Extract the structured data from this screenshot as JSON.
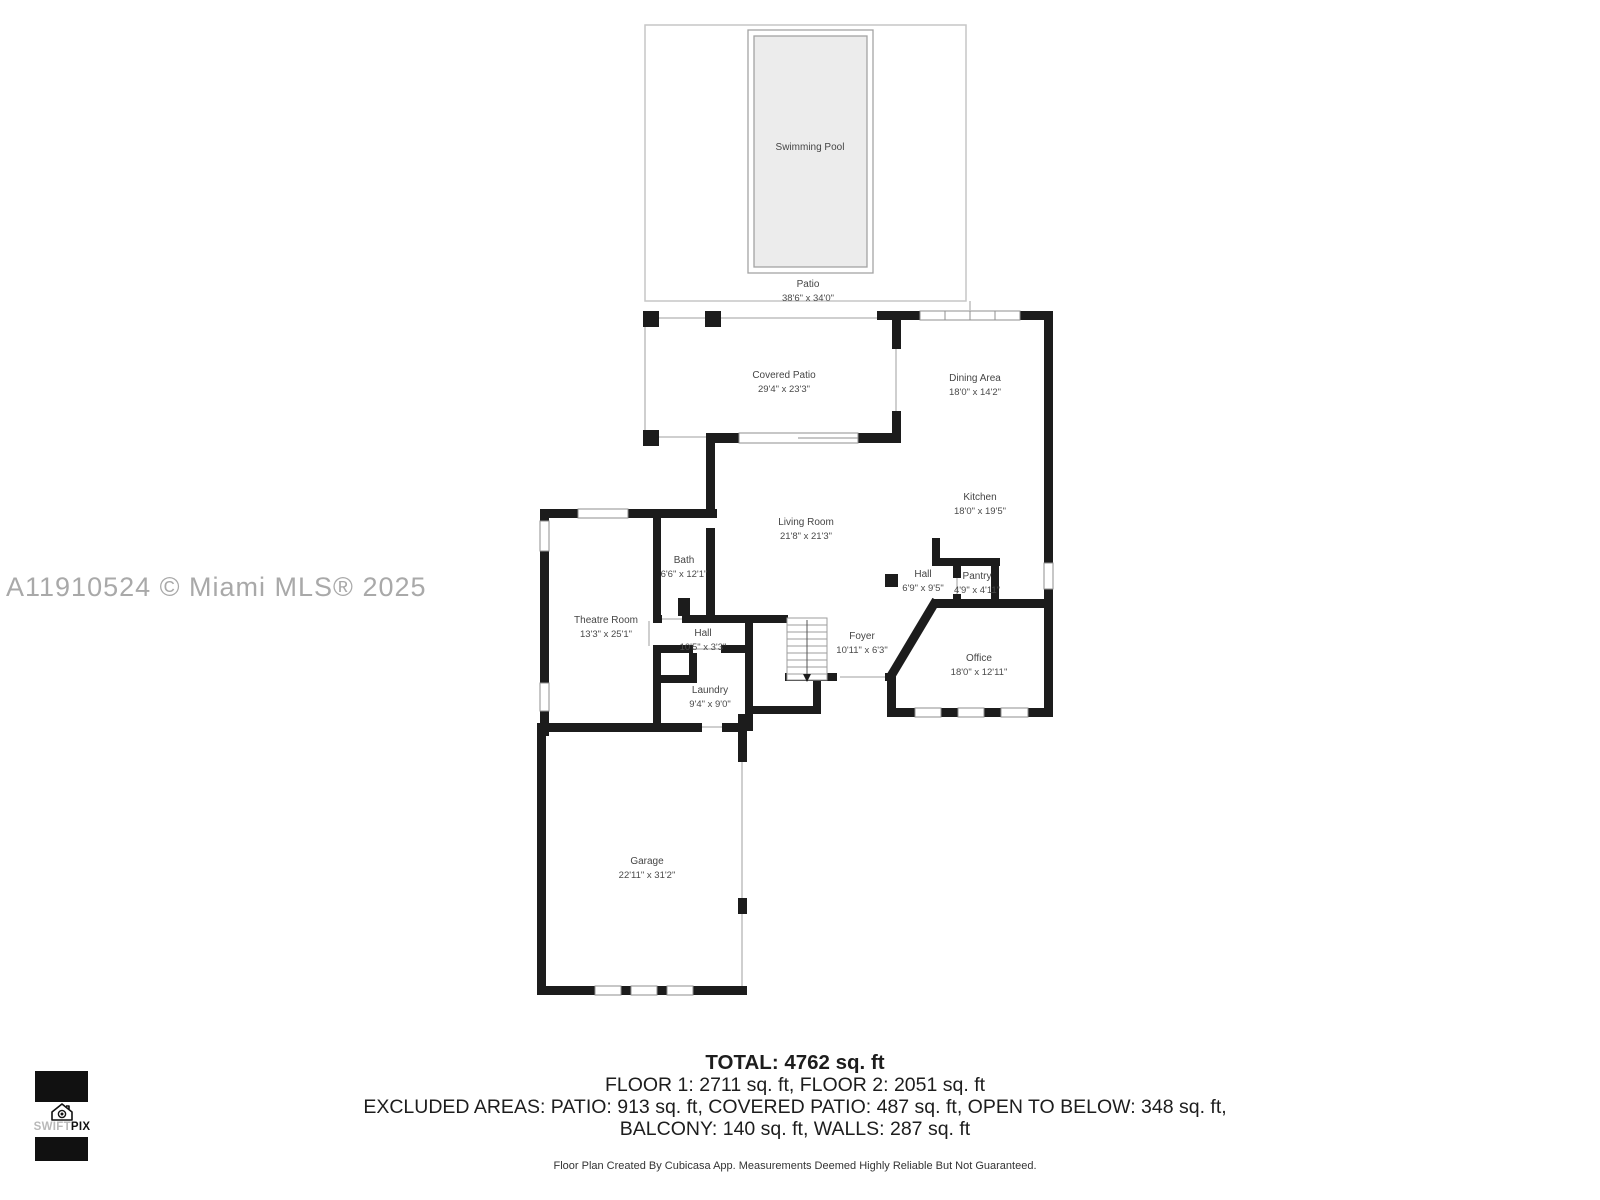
{
  "watermark": "A11910524 © Miami MLS® 2025",
  "logo": {
    "swift": "SWIFT",
    "pix": "PIX"
  },
  "rooms": {
    "swimming_pool": {
      "name": "Swimming Pool"
    },
    "patio": {
      "name": "Patio",
      "dims": "38'6\" x 34'0\""
    },
    "covered_patio": {
      "name": "Covered Patio",
      "dims": "29'4\" x 23'3\""
    },
    "dining_area": {
      "name": "Dining Area",
      "dims": "18'0\" x 14'2\""
    },
    "kitchen": {
      "name": "Kitchen",
      "dims": "18'0\" x 19'5\""
    },
    "living_room": {
      "name": "Living Room",
      "dims": "21'8\" x 21'3\""
    },
    "bath": {
      "name": "Bath",
      "dims": "6'6\" x 12'1\""
    },
    "theatre_room": {
      "name": "Theatre Room",
      "dims": "13'3\" x 25'1\""
    },
    "hall_lower": {
      "name": "Hall",
      "dims": "10'5\" x 3'3\""
    },
    "hall_kitchen": {
      "name": "Hall",
      "dims": "6'9\" x 9'5\""
    },
    "pantry": {
      "name": "Pantry",
      "dims": "4'9\" x 4'11\""
    },
    "foyer": {
      "name": "Foyer",
      "dims": "10'11\" x 6'3\""
    },
    "office": {
      "name": "Office",
      "dims": "18'0\" x 12'11\""
    },
    "laundry": {
      "name": "Laundry",
      "dims": "9'4\" x 9'0\""
    },
    "garage": {
      "name": "Garage",
      "dims": "22'11\" x 31'2\""
    }
  },
  "summary": {
    "total": "TOTAL: 4762 sq. ft",
    "floors": "FLOOR 1: 2711 sq. ft, FLOOR 2: 2051 sq. ft",
    "excluded_line1": "EXCLUDED AREAS: PATIO: 913 sq. ft, COVERED PATIO: 487 sq. ft, OPEN TO BELOW: 348 sq. ft,",
    "excluded_line2": "BALCONY: 140 sq. ft, WALLS: 287 sq. ft",
    "disclaimer": "Floor Plan Created By Cubicasa App. Measurements Deemed Highly Reliable But Not Guaranteed."
  },
  "colors": {
    "wall": "#1c1c1c",
    "thin_line": "#c2c2c2",
    "pool_fill": "#ececec",
    "window_stroke": "#8f8f8f",
    "label": "#454545",
    "watermark": "#a9a9a9"
  }
}
